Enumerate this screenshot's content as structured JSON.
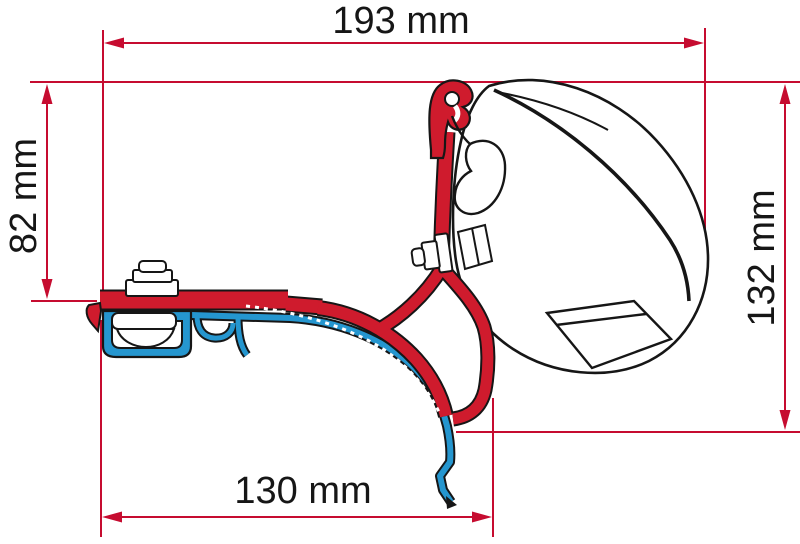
{
  "diagram": {
    "type": "technical-dimension-drawing",
    "dimensions": [
      {
        "id": "top-width",
        "label": "193 mm",
        "value": 193,
        "unit": "mm",
        "orientation": "horizontal"
      },
      {
        "id": "left-height",
        "label": "82 mm",
        "value": 82,
        "unit": "mm",
        "orientation": "vertical"
      },
      {
        "id": "right-height",
        "label": "132 mm",
        "value": 132,
        "unit": "mm",
        "orientation": "vertical"
      },
      {
        "id": "bottom-width",
        "label": "130 mm",
        "value": 130,
        "unit": "mm",
        "orientation": "horizontal"
      }
    ],
    "parts": [
      {
        "name": "awning-case-outline",
        "color": "#ffffff"
      },
      {
        "name": "adapter-bracket",
        "color": "#cf1b2d"
      },
      {
        "name": "roof-rail-profile",
        "color": "#2596cf"
      }
    ],
    "colors": {
      "dimension_red": "#c60c30",
      "bracket_red": "#cf1b2d",
      "rail_blue": "#2596cf",
      "ink": "#161616",
      "background": "#ffffff"
    }
  }
}
